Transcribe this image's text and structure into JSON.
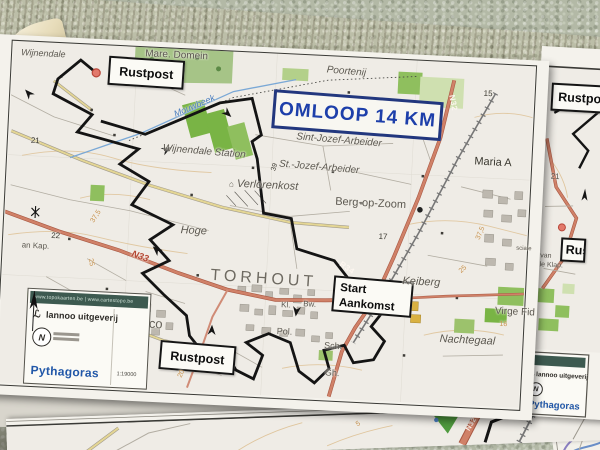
{
  "main_map": {
    "title": "OMLOOP 14 KM",
    "checkpoints": {
      "rustpost_top": "Rustpost",
      "rustpost_bottom": "Rustpost",
      "start_line1": "Start",
      "start_line2": "Aankomst"
    },
    "places": {
      "wijnendale": "Wijnendale",
      "mare_domein": "Mare. Domein",
      "poortenij": "Poortenij",
      "mouwbeek": "Mouwbeek",
      "wijnendale_station": "Wijnendale Station",
      "sint_jozef_arbeider": "Sint-Jozef-Arbeider",
      "st_jozef_arbeider": "St.-Jozef-Arbeider",
      "maria_a": "Maria A",
      "verlorenkost": "Verlorenkost",
      "berg_op_zoom": "Berg-op-Zoom",
      "hoge": "Hoge",
      "torhout": "TORHOUT",
      "keiberg": "Keiberg",
      "don_bosco": "Don Bosco",
      "virge_fid": "Virge Fid",
      "nachtegaal": "Nachtegaal",
      "an_kap": "an Kap.",
      "kl": "Kl.",
      "bw": "Bw.",
      "pol": "Pol.",
      "sch": "Sch.",
      "gh": "Gh.",
      "sciale": "sciale"
    },
    "roads": {
      "n33": "N33",
      "n32": "N32",
      "r34": "R34"
    },
    "numbers": {
      "n21": "21",
      "n22": "22",
      "n39": "39",
      "n15": "15",
      "n17": "17",
      "n16": "16",
      "c375_left": "37,5",
      "c375_right": "37,5",
      "c25_left": "25",
      "c25_right": "25",
      "c225": "22,5",
      "c20": "20"
    },
    "legend": {
      "websites": "www.topokaarten.be | www.cartestopo.be",
      "publisher": "lannoo uitgeverij",
      "brand": "Pythagoras",
      "scale": "1:19000",
      "ngi_monogram": "N"
    }
  },
  "right_map": {
    "rustpost": "Rustpost",
    "rustpost_partial": "Rustpost",
    "n21": "21",
    "n22": "22",
    "v_van": "V. van",
    "dale_klap": "dale Klap.",
    "legend": {
      "publisher": "lannoo uitgeverij",
      "brand": "Pythagoras"
    }
  },
  "bottom_map": {
    "n32": "N32",
    "c5": "5"
  },
  "icons": {
    "house": "⌂",
    "script_l": "ℒ"
  },
  "colors": {
    "route": "#141414",
    "main_road": "#d08168",
    "title_blue": "#1d3faa",
    "banner_green": "#3d5a50",
    "brand_blue": "#2157a8",
    "contour": "#c8924f",
    "forest": "#a6c487",
    "field": "#79b445",
    "wall": "#b3b9a6",
    "wood": "#b68a49"
  }
}
